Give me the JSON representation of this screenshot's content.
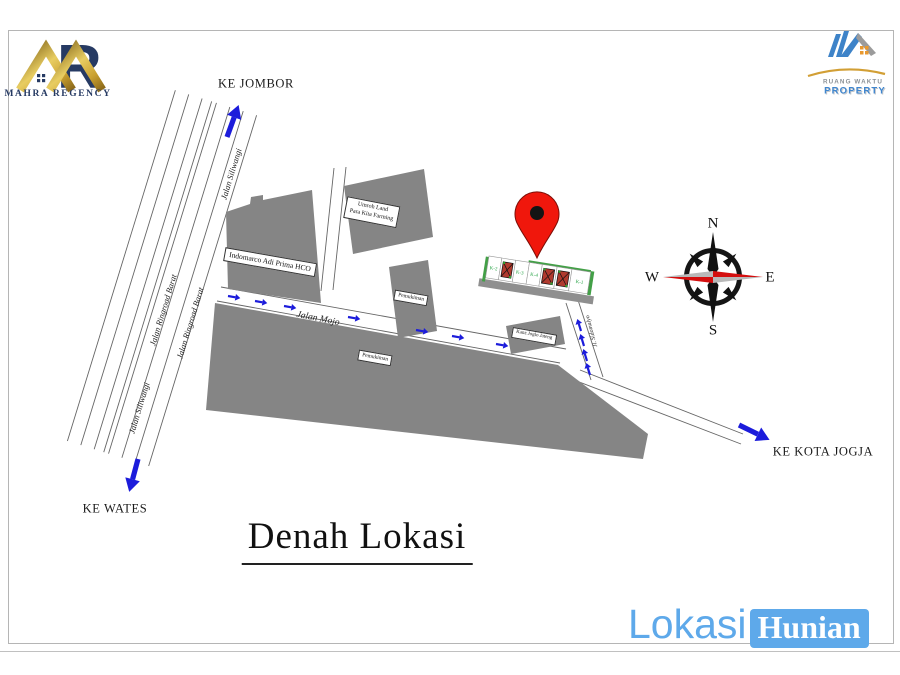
{
  "branding": {
    "mahra": {
      "name": "MAHRA REGENCY",
      "monogram": "R"
    },
    "ruang_waktu": {
      "line1": "RUANG WAKTU",
      "line2": "PROPERTY"
    }
  },
  "title": "Denah Lokasi",
  "footer_logo": {
    "word1": "Lokasi",
    "word2": "Hunian"
  },
  "directions": {
    "north": "KE JOMBOR",
    "south": "KE WATES",
    "east": "KE KOTA JOGJA"
  },
  "roads": {
    "siliwangi_upper": "Jalan Siliwangi",
    "siliwangi_lower": "Jalan Siliwangi",
    "ringroad_outer": "Jalan Ringroad Barat",
    "ringroad_inner": "Jalan Ringroad Barat",
    "mojo": "Jalan Mojo",
    "side_street": "Jl. Sidomulyo"
  },
  "landmarks": {
    "indomarco": "Indomarco Adi Prima HCO",
    "umroh_land_line1": "Umroh Land",
    "umroh_land_line2": "Para Kita Farming",
    "pemukiman_upper": "Pemukiman",
    "pemukiman_lower": "Pemukiman",
    "kanz": "Kanz Joglo Jateng"
  },
  "site_plan": {
    "plot_labels": [
      "K-2",
      "K-3",
      "K-4",
      "K-1"
    ]
  },
  "compass": {
    "north": "N",
    "south": "S",
    "east": "E",
    "west": "W"
  },
  "colors": {
    "arrow_blue": "#1c1cdb",
    "building_gray": "#858585",
    "pin_red": "#f0170c",
    "compass_red": "#d40f0f",
    "brand_gold": "#c9a02f",
    "brand_navy": "#263a63",
    "footer_blue": "#5ea9ea"
  }
}
